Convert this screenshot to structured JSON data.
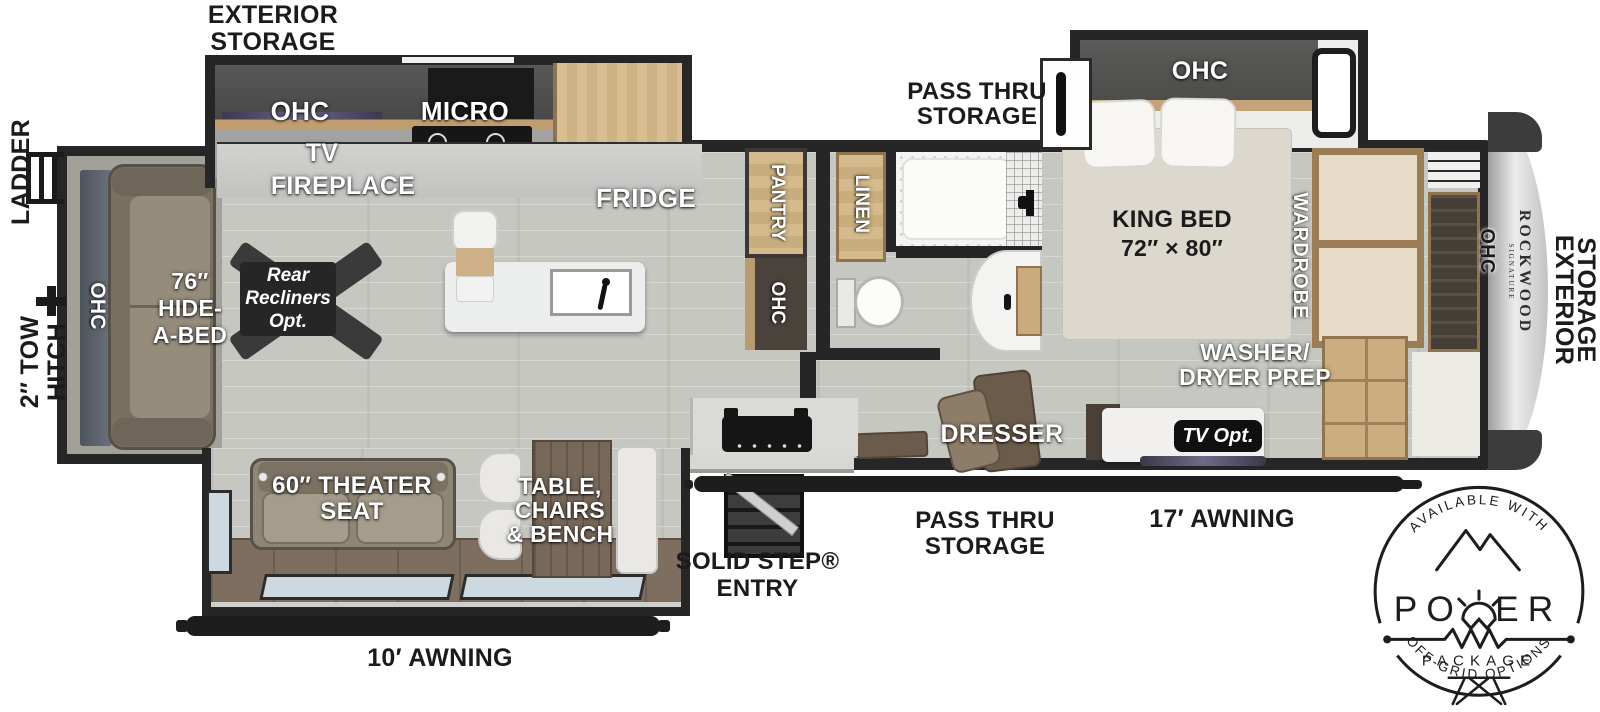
{
  "colors": {
    "wall": "#262626",
    "floor": "#c6c7c1",
    "wood": "#cbad80",
    "sofa": "#8f8575",
    "slide_floor": "#7d6e60",
    "window_glass": "#cdd9e0",
    "front_cap": "#d9d9d9",
    "ink": "#1b1b1b"
  },
  "exterior": {
    "storage_top": {
      "line1": "EXTERIOR",
      "line2": "STORAGE"
    },
    "storage_right": {
      "line1": "EXTERIOR",
      "line2": "STORAGE"
    },
    "ladder": "LADDER",
    "tow_hitch": {
      "line1": "2″ TOW",
      "line2": "HITCH"
    },
    "awning_rear": "10′ AWNING",
    "awning_front": "17′ AWNING",
    "pass_thru_top": {
      "line1": "PASS THRU",
      "line2": "STORAGE"
    },
    "pass_thru_bottom": {
      "line1": "PASS THRU",
      "line2": "STORAGE"
    },
    "entry": {
      "line1": "SOLID STEP®",
      "line2": "ENTRY"
    },
    "brand": "ROCKWOOD",
    "brand_sub": "SIGNATURE"
  },
  "living": {
    "ohc_rear": "OHC",
    "hide_a_bed": {
      "line1": "76″",
      "line2": "HIDE-",
      "line3": "A-BED"
    },
    "recliners": {
      "line1": "Rear",
      "line2": "Recliners",
      "line3": "Opt."
    },
    "tv": "TV",
    "fireplace": "FIREPLACE",
    "theater_seat": {
      "line1": "60″ THEATER",
      "line2": "SEAT"
    }
  },
  "kitchen": {
    "ohc": "OHC",
    "micro": "MICRO",
    "fridge": "FRIDGE",
    "pantry": "PANTRY",
    "ohc_lower": "OHC",
    "dinette": {
      "line1": "TABLE,",
      "line2": "CHAIRS",
      "line3": "& BENCH"
    }
  },
  "bath": {
    "linen": "LINEN"
  },
  "bedroom": {
    "ohc": "OHC",
    "king_bed": {
      "line1": "KING BED",
      "line2": "72″ × 80″"
    },
    "wardrobe": "WARDROBE",
    "washer": {
      "line1": "WASHER/",
      "line2": "DRYER PREP"
    },
    "dresser": "DRESSER",
    "tv_opt": "TV Opt.",
    "ohc_front": "OHC"
  },
  "badge": {
    "arc_top": "AVAILABLE WITH",
    "power_left": "PO",
    "power_right": "ER",
    "package": "PACKAGE",
    "arc_bottom": "OFF-GRID OPTIONS"
  }
}
